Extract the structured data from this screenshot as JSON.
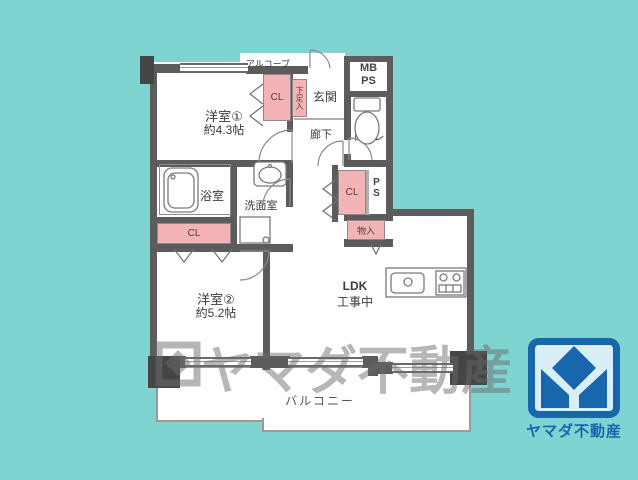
{
  "colors": {
    "background": "#7fd4d2",
    "wall": "#5c5c5c",
    "closet_pink": "#f4b3b5",
    "logo_blue": "#1766ae",
    "logo_bg": "#d9eef6",
    "watermark_gray": "#686868"
  },
  "floorplan": {
    "alcove": "アルコーブ",
    "room1": {
      "name": "洋室①",
      "size": "約4.3帖"
    },
    "room2": {
      "name": "洋室②",
      "size": "約5.2帖"
    },
    "ldk": {
      "name": "LDK",
      "status": "工事中"
    },
    "entrance": "玄関",
    "hallway": "廊下",
    "toilet": "トイレ",
    "bathroom": "浴室",
    "washroom": "洗面室",
    "balcony": "バルコニー",
    "closet1": "CL",
    "closet2": "CL",
    "closet3": "CL",
    "shoe_storage": "下足入",
    "storage": "物入",
    "mb": "MB",
    "ps": "PS",
    "ps2": "PS"
  },
  "watermark": {
    "text": "ヤマダ不動産"
  },
  "logo": {
    "company": "ヤマダ不動産"
  }
}
